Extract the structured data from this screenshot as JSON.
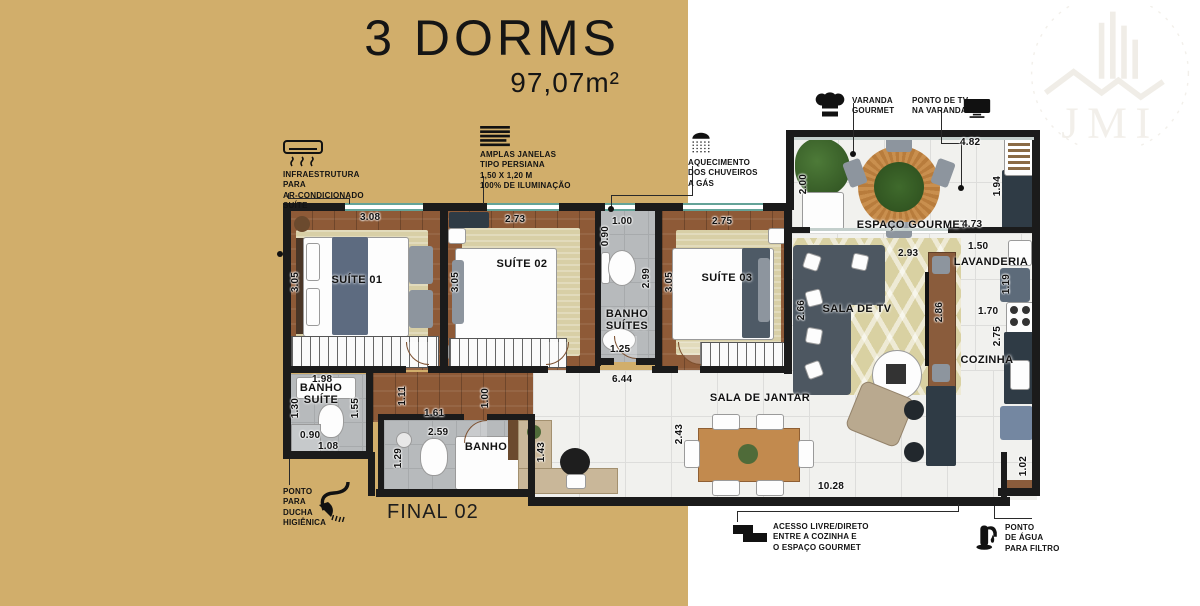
{
  "title": {
    "main": "3 DORMS",
    "area": "97,07m²"
  },
  "brand": {
    "name": "JMI"
  },
  "unit": {
    "label": "FINAL 02"
  },
  "callouts": {
    "ac": {
      "icon": "ac-unit-icon",
      "label": "INFRAESTRUTURA\nPARA\nAR-CONDICIONADO\nSUÍTE"
    },
    "windows": {
      "icon": "blinds-icon",
      "label": "AMPLAS JANELAS\nTIPO PERSIANA\n1,50 x 1,20 m\n100% DE ILUMINAÇÃO"
    },
    "gas": {
      "icon": "shower-icon",
      "label": "AQUECIMENTO\nDOS CHUVEIROS\nA GÁS"
    },
    "varanda": {
      "icon": "chef-hat-icon",
      "label": "VARANDA\nGOURMET"
    },
    "tv": {
      "icon": "tv-icon",
      "label": "PONTO DE TV\nNA VARANDA"
    },
    "ducha": {
      "icon": "handheld-shower-icon",
      "label": "PONTO\nPARA\nDUCHA\nHIGIÊNICA"
    },
    "acesso": {
      "icon": "steps-icon",
      "label": "ACESSO LIVRE/DIRETO\nENTRE A COZINHA E\nO ESPAÇO GOURMET"
    },
    "agua": {
      "icon": "faucet-icon",
      "label": "PONTO\nDE ÁGUA\nPARA FILTRO"
    }
  },
  "rooms": {
    "suite1": "SUÍTE 01",
    "suite2": "SUÍTE 02",
    "suite3": "SUÍTE 03",
    "banho_suites": "BANHO\nSUÍTES",
    "banho_suite": "BANHO\nSUÍTE",
    "banho": "BANHO",
    "sala_tv": "SALA DE TV",
    "sala_jantar": "SALA DE JANTAR",
    "espaco_gourmet": "ESPAÇO GOURMET",
    "lavanderia": "LAVANDERIA",
    "cozinha": "COZINHA"
  },
  "dims": {
    "suite1_w": "3.08",
    "suite1_d": "3.05",
    "suite2_w": "2.73",
    "suite2_d": "3.05",
    "suite3_w": "2.75",
    "suite3_d": "3.05",
    "banho_suites_top": "1.00",
    "banho_suites_nook": "0.90",
    "banho_suites_d": "2.99",
    "banho_suites_w": "1.25",
    "banho_suite_top": "1.98",
    "banho_suite_left": "1.30",
    "banho_suite_shower": "0.90",
    "banho_suite_bottom": "1.08",
    "banho_suite_right": "1.55",
    "hall_w1": "1.11",
    "hall_w2": "1.61",
    "hall_w3": "1.00",
    "hall_len": "6.44",
    "banho_w": "2.59",
    "banho_d": "1.29",
    "desk_d": "1.43",
    "jantar_d": "2.43",
    "jantar_len": "10.28",
    "tv_w": "2.93",
    "tv_left": "2.66",
    "tv_right": "2.86",
    "gourmet_w": "4.73",
    "varanda_left": "2.00",
    "varanda_top": "4.82",
    "varanda_right": "1.94",
    "lav_w": "1.50",
    "lav_d": "1.19",
    "coz_w": "1.70",
    "coz_d": "2.75",
    "coz_recess": "1.02"
  },
  "colors": {
    "gold": "#d1ae6b",
    "wall": "#1b1b1b",
    "window_teal": "#64a398"
  }
}
